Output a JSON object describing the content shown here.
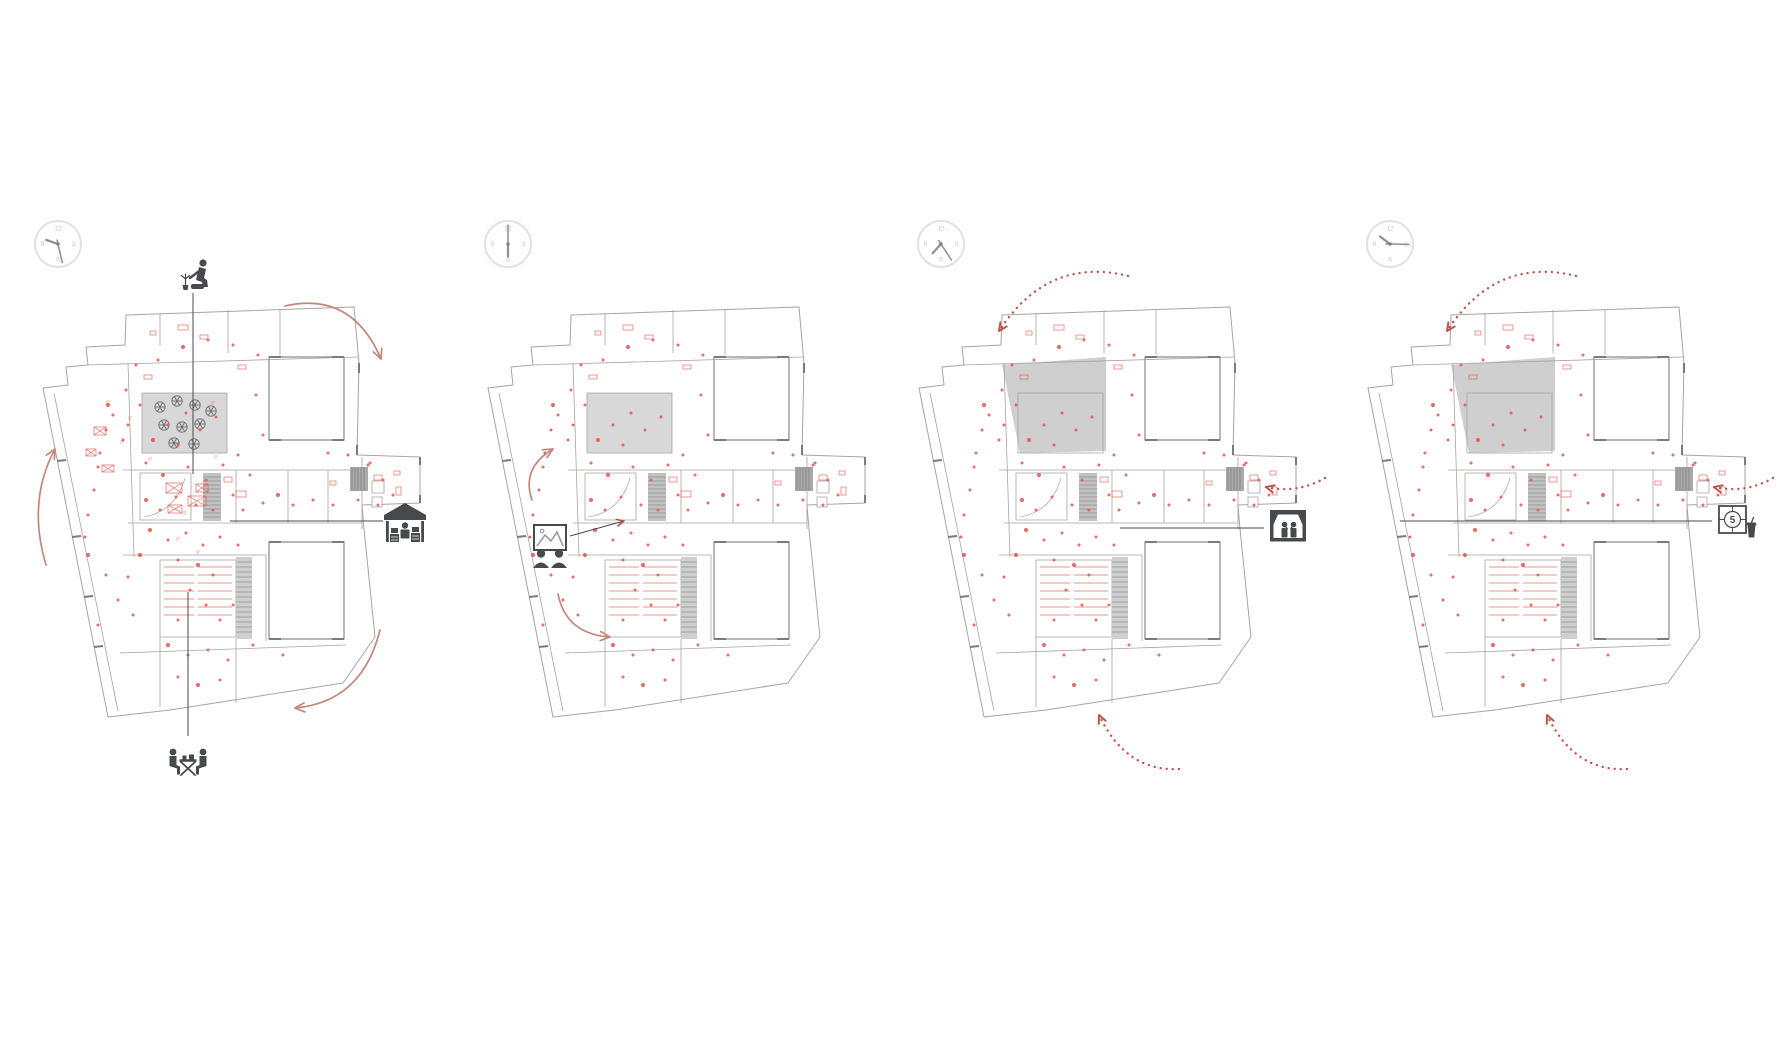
{
  "title": "four time-phase floor plan diagrams",
  "colors": {
    "background": "#ffffff",
    "wall": "#a8a49f",
    "wall_light": "#b5b1ac",
    "wall_dark": "#7b7b7b",
    "courtyard_fill": "#ffffff",
    "garden_fill_light": "#d8d8d8",
    "garden_fill_dark": "#cfcfcf",
    "stair_fill": "#c2c2c2",
    "stair_fill2": "#cfcfcf",
    "dark_block": "#a9a9a9",
    "accent_solid": "#c5867c",
    "accent_dotted": "#bc5048",
    "dot": "#e4564b",
    "furniture": "#e4564b",
    "tree": "#6e6e6e",
    "icon": "#474a4d",
    "callout": "#4a4a4a",
    "clock_ring": "#e2e2e2",
    "clock_numeral": "#c6c6c6",
    "clock_hand": "#8f8f8f"
  },
  "clock_numerals": [
    "12",
    "3",
    "6",
    "9"
  ],
  "film_icon_number": "5",
  "garden_shapes": {
    "light": [
      [
        114,
        88
      ],
      [
        199,
        88
      ],
      [
        199,
        148
      ],
      [
        114,
        148
      ]
    ],
    "dark": [
      [
        98,
        60
      ],
      [
        202,
        52
      ],
      [
        202,
        146
      ],
      [
        116,
        148
      ]
    ]
  },
  "garden_trees": [
    [
      132,
      102
    ],
    [
      149,
      96
    ],
    [
      167,
      100
    ],
    [
      183,
      106
    ],
    [
      136,
      120
    ],
    [
      154,
      122
    ],
    [
      172,
      119
    ],
    [
      146,
      138
    ],
    [
      166,
      139
    ]
  ],
  "dots": [
    [
      80,
      100
    ],
    [
      78,
      125
    ],
    [
      72,
      148
    ],
    [
      70,
      162
    ],
    [
      66,
      185
    ],
    [
      60,
      210
    ],
    [
      57,
      232
    ],
    [
      60,
      250
    ],
    [
      78,
      270
    ],
    [
      90,
      295
    ],
    [
      105,
      310
    ],
    [
      70,
      320
    ],
    [
      100,
      120
    ],
    [
      112,
      100
    ],
    [
      125,
      135
    ],
    [
      140,
      120
    ],
    [
      158,
      108
    ],
    [
      172,
      125
    ],
    [
      188,
      112
    ],
    [
      150,
      140
    ],
    [
      118,
      158
    ],
    [
      135,
      170
    ],
    [
      160,
      162
    ],
    [
      178,
      175
    ],
    [
      195,
      160
    ],
    [
      210,
      150
    ],
    [
      222,
      170
    ],
    [
      205,
      190
    ],
    [
      118,
      195
    ],
    [
      132,
      205
    ],
    [
      148,
      192
    ],
    [
      168,
      200
    ],
    [
      185,
      205
    ],
    [
      215,
      205
    ],
    [
      235,
      198
    ],
    [
      250,
      190
    ],
    [
      265,
      200
    ],
    [
      285,
      195
    ],
    [
      305,
      200
    ],
    [
      330,
      195
    ],
    [
      350,
      200
    ],
    [
      365,
      190
    ],
    [
      122,
      225
    ],
    [
      140,
      235
    ],
    [
      158,
      228
    ],
    [
      175,
      240
    ],
    [
      192,
      232
    ],
    [
      210,
      240
    ],
    [
      150,
      255
    ],
    [
      170,
      260
    ],
    [
      185,
      270
    ],
    [
      162,
      285
    ],
    [
      178,
      300
    ],
    [
      150,
      315
    ],
    [
      192,
      315
    ],
    [
      205,
      300
    ],
    [
      140,
      340
    ],
    [
      160,
      350
    ],
    [
      180,
      345
    ],
    [
      200,
      355
    ],
    [
      225,
      340
    ],
    [
      255,
      350
    ],
    [
      150,
      372
    ],
    [
      170,
      380
    ],
    [
      192,
      375
    ],
    [
      235,
      130
    ],
    [
      228,
      90
    ],
    [
      230,
      50
    ],
    [
      205,
      40
    ],
    [
      180,
      35
    ],
    [
      155,
      42
    ],
    [
      130,
      55
    ],
    [
      108,
      60
    ],
    [
      98,
      85
    ],
    [
      320,
      150
    ],
    [
      342,
      158
    ],
    [
      300,
      148
    ],
    [
      112,
      250
    ],
    [
      100,
      272
    ],
    [
      340,
      160
    ],
    [
      355,
      175
    ],
    [
      95,
      135
    ],
    [
      85,
      110
    ]
  ],
  "plan1_tables": [
    [
      138,
      178,
      16,
      10
    ],
    [
      160,
      191,
      18,
      10
    ],
    [
      140,
      200,
      14,
      8
    ],
    [
      168,
      179,
      12,
      8
    ],
    [
      66,
      122,
      12,
      8
    ],
    [
      58,
      144,
      10,
      7
    ],
    [
      74,
      160,
      12,
      7
    ]
  ],
  "plan1_micro_labels": [
    [
      78,
      96
    ],
    [
      92,
      136
    ],
    [
      120,
      153
    ],
    [
      186,
      151
    ],
    [
      155,
      207
    ],
    [
      168,
      246
    ],
    [
      148,
      233
    ],
    [
      183,
      97
    ],
    [
      100,
      112
    ]
  ],
  "panels": [
    {
      "id": "plan-1-market-morning",
      "plan_x": 28,
      "garden": "light",
      "garden_trees": true,
      "extra_furniture": true,
      "arrow_style": "solid",
      "clock": {
        "cx": 58,
        "cy": 244,
        "time": "09:33",
        "hour_angle": 289,
        "minute_angle": 167
      },
      "arrows": [
        {
          "path": "M285,306 Q352,291 381,359",
          "tip": [
            381,
            359
          ],
          "head_angle": 67
        },
        {
          "path": "M46,565 Q27,501 55,449",
          "tip": [
            55,
            449
          ],
          "head_angle": -62
        },
        {
          "path": "M380,630 Q362,702 295,708",
          "tip": [
            295,
            708
          ],
          "head_angle": 175
        }
      ],
      "callouts": [
        {
          "x1": 193,
          "y1": 293,
          "x2": 193,
          "y2": 474
        },
        {
          "x1": 230,
          "y1": 521,
          "x2": 383,
          "y2": 521
        },
        {
          "x1": 188,
          "y1": 592,
          "x2": 188,
          "y2": 736
        }
      ],
      "icons": [
        {
          "name": "gardening-person",
          "x": 177,
          "y": 255,
          "size": 40
        },
        {
          "name": "market-stall",
          "x": 383,
          "y": 500,
          "size": 44
        },
        {
          "name": "communal-table",
          "x": 166,
          "y": 735,
          "size": 44
        }
      ]
    },
    {
      "id": "plan-2-exhibition",
      "plan_x": 473,
      "garden": "light",
      "garden_trees": false,
      "extra_furniture": false,
      "arrow_style": "solid",
      "clock": {
        "cx": 508,
        "cy": 244,
        "time": "06:00",
        "hour_angle": 180,
        "minute_angle": 0
      },
      "arrows": [
        {
          "path": "M532,500 Q521,468 553,449",
          "tip": [
            553,
            449
          ],
          "head_angle": -31
        },
        {
          "path": "M558,594 Q566,634 610,637",
          "tip": [
            610,
            637
          ],
          "head_angle": 4
        }
      ],
      "callouts": [
        {
          "x1": 570,
          "y1": 536,
          "x2": 624,
          "y2": 521,
          "red_head": true,
          "head_angle": -15
        }
      ],
      "icons": [
        {
          "name": "art-viewing",
          "x": 527,
          "y": 522,
          "size": 46
        }
      ]
    },
    {
      "id": "plan-3-performance",
      "plan_x": 904,
      "garden": "dark",
      "garden_trees": false,
      "extra_furniture": false,
      "arrow_style": "dotted",
      "clock": {
        "cx": 941,
        "cy": 244,
        "time": "07:24",
        "hour_angle": 222,
        "minute_angle": 147
      },
      "arrows": [
        {
          "path": "M1128,276 Q1048,256 999,331",
          "tip": [
            999,
            331
          ],
          "head_angle": 123
        },
        {
          "path": "M1325,478 Q1297,494 1266,487",
          "tip": [
            1266,
            487
          ],
          "head_angle": 193
        },
        {
          "path": "M1179,769 Q1126,772 1099,715",
          "tip": [
            1099,
            715
          ],
          "head_angle": 245
        }
      ],
      "callouts": [
        {
          "x1": 1120,
          "y1": 528,
          "x2": 1264,
          "y2": 528
        }
      ],
      "icons": [
        {
          "name": "stage-performance",
          "x": 1268,
          "y": 507,
          "size": 40
        }
      ]
    },
    {
      "id": "plan-4-cinema",
      "plan_x": 1353,
      "garden": "dark",
      "garden_trees": false,
      "extra_furniture": false,
      "arrow_style": "dotted",
      "clock": {
        "cx": 1390,
        "cy": 244,
        "time": "10:15",
        "hour_angle": 307,
        "minute_angle": 91
      },
      "arrows": [
        {
          "path": "M1576,276 Q1496,256 1447,331",
          "tip": [
            1447,
            331
          ],
          "head_angle": 123
        },
        {
          "path": "M1773,478 Q1745,494 1714,487",
          "tip": [
            1714,
            487
          ],
          "head_angle": 193
        },
        {
          "path": "M1627,769 Q1574,772 1547,715",
          "tip": [
            1547,
            715
          ],
          "head_angle": 245
        }
      ],
      "callouts": [
        {
          "x1": 1400,
          "y1": 521,
          "x2": 1712,
          "y2": 521
        }
      ],
      "icons": [
        {
          "name": "film-screening",
          "x": 1718,
          "y": 502,
          "size": 46
        }
      ]
    }
  ]
}
